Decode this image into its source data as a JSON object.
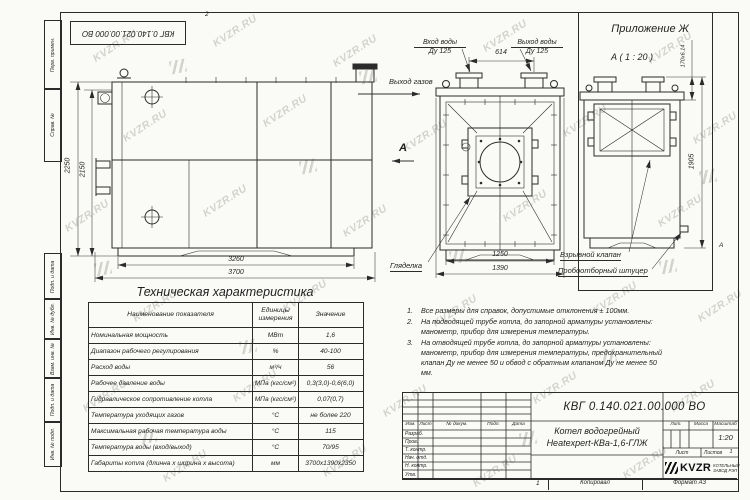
{
  "page": {
    "watermark_text": "KVZR.RU"
  },
  "frame": {
    "top_stamp": "КВГ 0.140.021.00.000 ВО",
    "zone_top": "2",
    "zone_bottom": "1",
    "zone_right": "А",
    "left_labels": [
      "Перв. примен.",
      "Справ. №",
      "Подп. и дата",
      "Инв. № дубл.",
      "Взам. инв. №",
      "Подп. и дата",
      "Инв. № подл."
    ]
  },
  "side_view": {
    "gas_outlet_label": "Выход газов",
    "view_arrow_label": "А",
    "dims": {
      "height_outer": "2250",
      "height_inner": "2150",
      "width_inner": "3260",
      "width_outer": "3700"
    }
  },
  "front_view": {
    "inlet_label": "Вход воды",
    "inlet_dn": "Ду 125",
    "outlet_label": "Выход воды",
    "outlet_dn": "Ду 125",
    "nozzle_spacing": "614",
    "sight_glass_label": "Гляделка",
    "dims": {
      "width_inner": "1250",
      "width_outer": "1390"
    }
  },
  "appendix": {
    "title": "Приложение Ж",
    "view_label": "А ( 1 : 20 )",
    "dim_top": "170x6.14",
    "dim_height": "1905",
    "explosion_valve_label": "Взрывной клапан",
    "sampling_label": "Пробоотборный штуцер"
  },
  "table": {
    "title": "Техническая характеристика",
    "headers": [
      "Наименование показателя",
      "Единицы измерения",
      "Значение"
    ],
    "rows": [
      [
        "Номинальная мощность",
        "МВт",
        "1,6"
      ],
      [
        "Диапазон рабочего регулирования",
        "%",
        "40-100"
      ],
      [
        "Расход воды",
        "м³/ч",
        "56"
      ],
      [
        "Рабочее давление воды",
        "МПа (кгс/см²)",
        "0,3(3,0)-0,6(6,0)"
      ],
      [
        "Гидравлическое сопротивление котла",
        "МПа (кгс/см²)",
        "0,07(0,7)"
      ],
      [
        "Температура уходящих газов",
        "°С",
        "не более 220"
      ],
      [
        "Максимальная рабочая температура воды",
        "°С",
        "115"
      ],
      [
        "Температура воды (вход/выход)",
        "°С",
        "70/95"
      ],
      [
        "Габариты котла (длинна х ширина х высота)",
        "мм",
        "3700х1390х2350"
      ]
    ]
  },
  "notes": [
    {
      "num": "1.",
      "text": "Все размеры для справок, допустимые отклонения ± 100мм."
    },
    {
      "num": "2.",
      "text": "На подводящей трубе котла, до запорной арматуры установлены: манометр, прибор для измерения температуры."
    },
    {
      "num": "3.",
      "text": "На отводящей трубе котла, до запорной арматуры установлены: манометр, прибор для измерения температуры, предохранительный клапан Ду не менее 50 и обвод с обратным клапаном Ду не менее 50 мм."
    }
  ],
  "title_block": {
    "doc_number": "КВГ 0.140.021.00.000 ВО",
    "product_line1": "Котел водогрейный",
    "product_line2": "Heatexpert-КВа-1,6-ГЛЖ",
    "header_cols": [
      "Изм.",
      "Лист",
      "№ докум.",
      "Подп.",
      "Дата"
    ],
    "row_labels": [
      "Разраб.",
      "Пров.",
      "Т. контр.",
      "Нач. отд.",
      "Н. контр.",
      "Утв."
    ],
    "lit_label": "Лит.",
    "mass_label": "Масса",
    "scale_label": "Масштаб",
    "scale_value": "1:20",
    "sheet_label": "Лист",
    "sheets_label": "Листов",
    "sheets_value": "1",
    "logo_text": "KVZR",
    "company_line1": "КОТЕЛЬНЫЙ",
    "company_line2": "ЗАВОД РЭП",
    "copied_label": "Копировал",
    "format_label": "Формат А3"
  }
}
